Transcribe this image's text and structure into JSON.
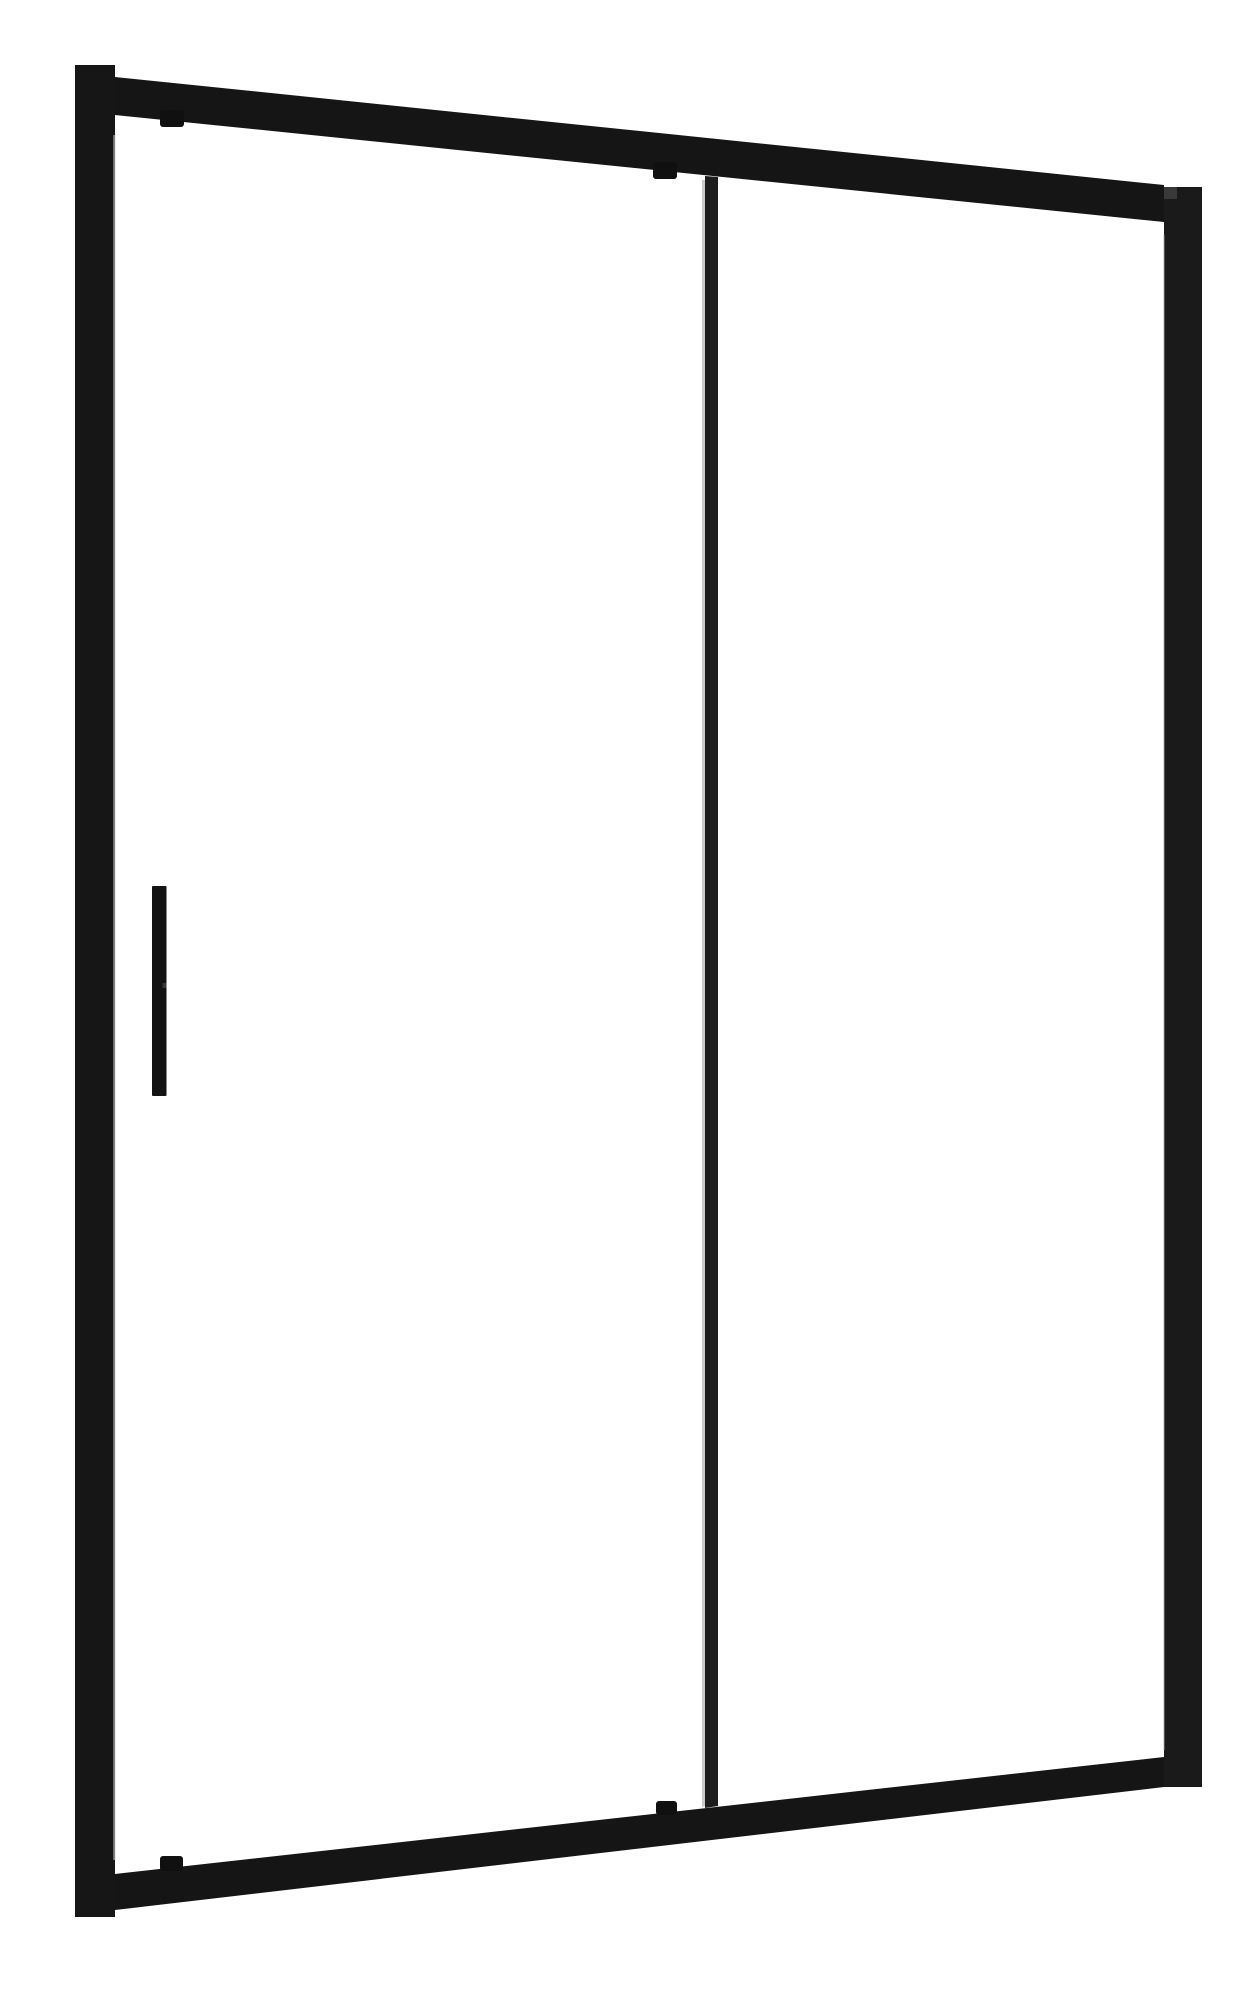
{
  "canvas": {
    "width": 1251,
    "height": 2000,
    "background_color": "#ffffff"
  },
  "subject": {
    "kind": "product-photo",
    "label": "black-framed-sliding-glass-shower-door",
    "frame_color": "#161616",
    "hardware_color": "#101010",
    "glass_color": "#ffffff",
    "edge_highlight_color": "#c4c4c4"
  },
  "parts": [
    {
      "name": "glass-panel-left",
      "shape": "polygon",
      "fill": "transparent",
      "points": [
        [
          115,
          115
        ],
        [
          705,
          176
        ],
        [
          705,
          1808
        ],
        [
          115,
          1874
        ]
      ]
    },
    {
      "name": "glass-panel-right",
      "shape": "polygon",
      "fill": "transparent",
      "points": [
        [
          718,
          177
        ],
        [
          1164,
          222
        ],
        [
          1164,
          1757
        ],
        [
          718,
          1806
        ]
      ]
    },
    {
      "name": "left-frame-stile",
      "shape": "polygon",
      "fill": "#161616",
      "points": [
        [
          75,
          65
        ],
        [
          115,
          65
        ],
        [
          115,
          1917
        ],
        [
          75,
          1917
        ]
      ]
    },
    {
      "name": "top-frame-rail",
      "shape": "polygon",
      "fill": "#151515",
      "points": [
        [
          115,
          77
        ],
        [
          1164,
          185
        ],
        [
          1164,
          222
        ],
        [
          115,
          115
        ]
      ]
    },
    {
      "name": "bottom-frame-rail",
      "shape": "polygon",
      "fill": "#151515",
      "points": [
        [
          115,
          1874
        ],
        [
          1164,
          1757
        ],
        [
          1164,
          1787
        ],
        [
          115,
          1910
        ]
      ]
    },
    {
      "name": "right-frame-stile",
      "shape": "polygon",
      "fill": "#1a1a1a",
      "points": [
        [
          1164,
          187
        ],
        [
          1202,
          187
        ],
        [
          1202,
          1787
        ],
        [
          1164,
          1787
        ]
      ]
    },
    {
      "name": "top-rail-endcap-highlight",
      "shape": "rect",
      "fill": "#3f3f3f",
      "opacity": 0.85,
      "x": 1164,
      "y": 187,
      "w": 13,
      "h": 12
    },
    {
      "name": "left-stile-inner-edge-highlight",
      "shape": "rect",
      "fill": "#cccccc",
      "opacity": 0.6,
      "x": 113.2,
      "y": 135,
      "w": 2.4,
      "h": 1725
    },
    {
      "name": "right-stile-inner-edge-highlight",
      "shape": "rect",
      "fill": "#aaaaaa",
      "opacity": 0.4,
      "x": 1163,
      "y": 235,
      "w": 2,
      "h": 1515
    },
    {
      "name": "center-divider-edge-highlight",
      "shape": "polygon",
      "fill": "#c2c2c2",
      "opacity": 0.85,
      "points": [
        [
          702,
          180
        ],
        [
          705.5,
          180
        ],
        [
          705.5,
          1806
        ],
        [
          702,
          1807
        ]
      ]
    },
    {
      "name": "center-glass-divider",
      "shape": "polygon",
      "fill": "#1d1d1d",
      "points": [
        [
          705,
          176
        ],
        [
          718,
          177
        ],
        [
          718,
          1806
        ],
        [
          705,
          1808
        ]
      ]
    },
    {
      "name": "clip-top-left",
      "shape": "rect",
      "fill": "#101010",
      "rx": 3,
      "x": 160,
      "y": 110,
      "w": 24,
      "h": 17
    },
    {
      "name": "clip-top-center",
      "shape": "rect",
      "fill": "#101010",
      "rx": 3,
      "x": 653,
      "y": 162,
      "w": 24,
      "h": 17
    },
    {
      "name": "clip-bottom-left",
      "shape": "rect",
      "fill": "#101010",
      "rx": 3,
      "x": 160,
      "y": 1856,
      "w": 23,
      "h": 15
    },
    {
      "name": "clip-bottom-center",
      "shape": "rect",
      "fill": "#101010",
      "rx": 3,
      "x": 656,
      "y": 1801,
      "w": 21,
      "h": 14
    },
    {
      "name": "door-handle",
      "shape": "rect",
      "fill": "#131313",
      "rx": 1,
      "x": 152,
      "y": 886,
      "w": 14.5,
      "h": 210
    },
    {
      "name": "door-handle-seam",
      "shape": "rect",
      "fill": "#3c3c3c",
      "opacity": 0.9,
      "x": 162.5,
      "y": 983,
      "w": 4,
      "h": 5
    }
  ]
}
